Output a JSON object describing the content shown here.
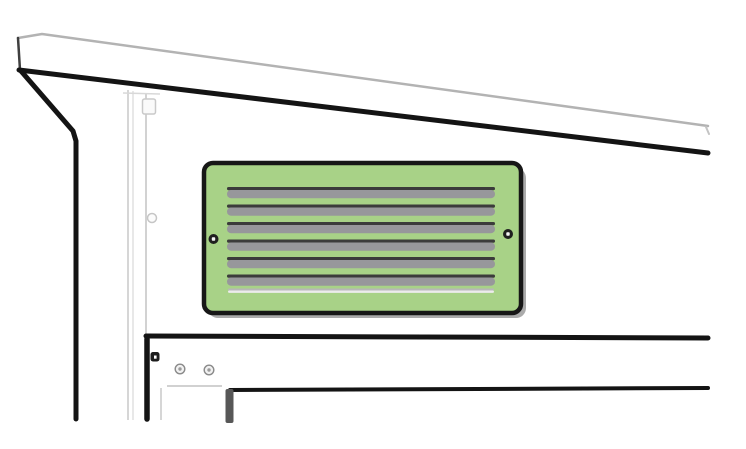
{
  "canvas": {
    "width": 746,
    "height": 449,
    "background": "#ffffff"
  },
  "colors": {
    "outline_dark": "#141414",
    "outline_medium": "#3f3f3f",
    "fascia_gray": "#b3b3b3",
    "post_light_gray": "#d6d6d6",
    "vent_green": "#a8d287",
    "louver_gray": "#97979b",
    "louver_dark": "#3b3b3b",
    "panel_shadow_gray": "#ababab",
    "screw_dark": "#1f1f1f",
    "jamb_gray": "#575757"
  },
  "vent_panel": {
    "louver_count": 7,
    "full_louver_count": 6,
    "thin_louver_count": 1,
    "screw_count": 2,
    "fill_color": "#a8d287",
    "x": 204,
    "y": 163,
    "width": 317,
    "height": 150,
    "corner_radius": 9
  },
  "frame": {
    "rail_screw_count": 2,
    "rail_bolt_count": 1
  },
  "shapes": [
    {
      "name": "fascia-top-edge-line",
      "tag": "polyline",
      "attrs": {
        "points": "18,38 42,34 708,126",
        "fill": "none",
        "stroke": "#b3b3b3",
        "stroke-width": "2.5",
        "stroke-linecap": "round",
        "stroke-linejoin": "round"
      }
    },
    {
      "name": "fascia-left-edge-line",
      "tag": "polyline",
      "attrs": {
        "points": "18,38 20,70",
        "fill": "none",
        "stroke": "#3f3f3f",
        "stroke-width": "2.5",
        "stroke-linecap": "round"
      }
    },
    {
      "name": "fascia-right-end-tick",
      "tag": "polyline",
      "attrs": {
        "points": "706,127 709,134",
        "fill": "none",
        "stroke": "#c4c4c4",
        "stroke-width": "2",
        "stroke-linecap": "round"
      }
    },
    {
      "name": "eave-bottom-line",
      "tag": "polyline",
      "attrs": {
        "points": "19,70 708,153",
        "fill": "none",
        "stroke": "#141414",
        "stroke-width": "5",
        "stroke-linecap": "round"
      }
    },
    {
      "name": "corner-trim-line",
      "tag": "polyline",
      "attrs": {
        "points": "21,71 73,131 76,141 76,419",
        "fill": "none",
        "stroke": "#141414",
        "stroke-width": "5",
        "stroke-linecap": "round",
        "stroke-linejoin": "round"
      }
    },
    {
      "name": "post-edge-line-outer",
      "tag": "polyline",
      "attrs": {
        "points": "128,90 128,420",
        "fill": "none",
        "stroke": "#d6d6d6",
        "stroke-width": "2"
      }
    },
    {
      "name": "post-edge-line-inner",
      "tag": "polyline",
      "attrs": {
        "points": "133,91 133,420",
        "fill": "none",
        "stroke": "#e0e0e0",
        "stroke-width": "1.5"
      }
    },
    {
      "name": "post-edge-line-right",
      "tag": "polyline",
      "attrs": {
        "points": "146,93 146,334",
        "fill": "none",
        "stroke": "#d2d2d2",
        "stroke-width": "2"
      }
    },
    {
      "name": "post-cap-line",
      "tag": "polyline",
      "attrs": {
        "points": "123,93 160,94",
        "fill": "none",
        "stroke": "#d8d8d8",
        "stroke-width": "1.5"
      }
    },
    {
      "name": "post-bracket",
      "tag": "rect",
      "attrs": {
        "x": "142.5",
        "y": "99",
        "width": "13",
        "height": "15",
        "rx": "2",
        "fill": "#fafafa",
        "stroke": "#c9c9c9",
        "stroke-width": "1.5"
      }
    },
    {
      "name": "post-screw",
      "tag": "circle",
      "attrs": {
        "cx": "152",
        "cy": "218",
        "r": "4.5",
        "fill": "#fcfcfc",
        "stroke": "#c6c6c6",
        "stroke-width": "1.5"
      }
    },
    {
      "name": "vent-panel-shadow",
      "tag": "rect",
      "attrs": {
        "x": "208",
        "y": "168",
        "width": "318",
        "height": "150",
        "rx": "10",
        "fill": "#ababab"
      }
    },
    {
      "name": "vent-panel-face",
      "tag": "rect",
      "attrs": {
        "x": "204",
        "y": "163",
        "width": "317",
        "height": "150",
        "rx": "9",
        "fill": "#a8d287",
        "stroke": "#171717",
        "stroke-width": "4.5"
      }
    },
    {
      "name": "louver-1-edge",
      "tag": "rect",
      "attrs": {
        "x": "227",
        "y": "187",
        "width": "268",
        "height": "3.2",
        "rx": "1.6",
        "fill": "#3b3b3b"
      }
    },
    {
      "name": "louver-1-body",
      "tag": "rect",
      "attrs": {
        "x": "227",
        "y": "190",
        "width": "268",
        "height": "8.2",
        "rx": "4",
        "fill": "#97979b"
      }
    },
    {
      "name": "louver-2-edge",
      "tag": "rect",
      "attrs": {
        "x": "227",
        "y": "204.5",
        "width": "268",
        "height": "3.2",
        "rx": "1.6",
        "fill": "#3b3b3b"
      }
    },
    {
      "name": "louver-2-body",
      "tag": "rect",
      "attrs": {
        "x": "227",
        "y": "207.5",
        "width": "268",
        "height": "8.2",
        "rx": "4",
        "fill": "#97979b"
      }
    },
    {
      "name": "louver-3-edge",
      "tag": "rect",
      "attrs": {
        "x": "227",
        "y": "222",
        "width": "268",
        "height": "3.2",
        "rx": "1.6",
        "fill": "#3b3b3b"
      }
    },
    {
      "name": "louver-3-body",
      "tag": "rect",
      "attrs": {
        "x": "227",
        "y": "225",
        "width": "268",
        "height": "8.2",
        "rx": "4",
        "fill": "#97979b"
      }
    },
    {
      "name": "louver-4-edge",
      "tag": "rect",
      "attrs": {
        "x": "227",
        "y": "239.5",
        "width": "268",
        "height": "3.2",
        "rx": "1.6",
        "fill": "#3b3b3b"
      }
    },
    {
      "name": "louver-4-body",
      "tag": "rect",
      "attrs": {
        "x": "227",
        "y": "242.5",
        "width": "268",
        "height": "8.2",
        "rx": "4",
        "fill": "#97979b"
      }
    },
    {
      "name": "louver-5-edge",
      "tag": "rect",
      "attrs": {
        "x": "227",
        "y": "257",
        "width": "268",
        "height": "3.2",
        "rx": "1.6",
        "fill": "#3b3b3b"
      }
    },
    {
      "name": "louver-5-body",
      "tag": "rect",
      "attrs": {
        "x": "227",
        "y": "260",
        "width": "268",
        "height": "8.2",
        "rx": "4",
        "fill": "#97979b"
      }
    },
    {
      "name": "louver-6-edge",
      "tag": "rect",
      "attrs": {
        "x": "227",
        "y": "274.5",
        "width": "268",
        "height": "3.2",
        "rx": "1.6",
        "fill": "#3b3b3b"
      }
    },
    {
      "name": "louver-6-body",
      "tag": "rect",
      "attrs": {
        "x": "227",
        "y": "277.5",
        "width": "268",
        "height": "8.2",
        "rx": "4",
        "fill": "#97979b"
      }
    },
    {
      "name": "louver-7-thin-edge",
      "tag": "rect",
      "attrs": {
        "x": "228",
        "y": "288.5",
        "width": "266",
        "height": "2",
        "rx": "1",
        "fill": "#b7b7b7"
      }
    },
    {
      "name": "louver-7-thin-body",
      "tag": "rect",
      "attrs": {
        "x": "228",
        "y": "290.5",
        "width": "266",
        "height": "2.4",
        "rx": "1.2",
        "fill": "#ececec"
      }
    },
    {
      "name": "panel-screw-left",
      "tag": "circle",
      "attrs": {
        "cx": "213.5",
        "cy": "239",
        "r": "5",
        "fill": "#1f1f1f"
      }
    },
    {
      "name": "panel-screw-left-center",
      "tag": "rect",
      "attrs": {
        "x": "211.8",
        "y": "237.3",
        "width": "3.4",
        "height": "3.4",
        "rx": "0.8",
        "fill": "#f5f5f5"
      }
    },
    {
      "name": "panel-screw-right",
      "tag": "circle",
      "attrs": {
        "cx": "508",
        "cy": "234",
        "r": "5",
        "fill": "#1f1f1f"
      }
    },
    {
      "name": "panel-screw-right-center",
      "tag": "rect",
      "attrs": {
        "x": "506.3",
        "y": "232.3",
        "width": "3.4",
        "height": "3.4",
        "rx": "0.8",
        "fill": "#f5f5f5"
      }
    },
    {
      "name": "rail-top-line",
      "tag": "polyline",
      "attrs": {
        "points": "146,336 708,338",
        "fill": "none",
        "stroke": "#141414",
        "stroke-width": "5",
        "stroke-linecap": "round"
      }
    },
    {
      "name": "rail-left-edge-line",
      "tag": "polyline",
      "attrs": {
        "points": "147,339 147,419",
        "fill": "none",
        "stroke": "#141414",
        "stroke-width": "5.5",
        "stroke-linecap": "round"
      }
    },
    {
      "name": "rail-bolt",
      "tag": "rect",
      "attrs": {
        "x": "150.5",
        "y": "352",
        "width": "9",
        "height": "9.5",
        "rx": "2.5",
        "fill": "#1c1c1c"
      }
    },
    {
      "name": "rail-bolt-center",
      "tag": "rect",
      "attrs": {
        "x": "154",
        "y": "355.5",
        "width": "2.6",
        "height": "3.2",
        "fill": "#ffffff"
      }
    },
    {
      "name": "rail-screw-1",
      "tag": "circle",
      "attrs": {
        "cx": "180",
        "cy": "369",
        "r": "4.8",
        "fill": "#f1f1f1",
        "stroke": "#8a8a8a",
        "stroke-width": "1.4"
      }
    },
    {
      "name": "rail-screw-1-center",
      "tag": "circle",
      "attrs": {
        "cx": "180",
        "cy": "369",
        "r": "1.7",
        "fill": "#9b9b9b"
      }
    },
    {
      "name": "rail-screw-2",
      "tag": "circle",
      "attrs": {
        "cx": "209",
        "cy": "370",
        "r": "4.8",
        "fill": "#f1f1f1",
        "stroke": "#8a8a8a",
        "stroke-width": "1.4"
      }
    },
    {
      "name": "rail-screw-2-center",
      "tag": "circle",
      "attrs": {
        "cx": "209",
        "cy": "370",
        "r": "1.7",
        "fill": "#9b9b9b"
      }
    },
    {
      "name": "rail-bottom-line",
      "tag": "polyline",
      "attrs": {
        "points": "167,386 222,386",
        "fill": "none",
        "stroke": "#c2c2c2",
        "stroke-width": "1.6"
      }
    },
    {
      "name": "post-lower-edge-line",
      "tag": "polyline",
      "attrs": {
        "points": "161,388 161,420",
        "fill": "none",
        "stroke": "#d6d6d6",
        "stroke-width": "2"
      }
    },
    {
      "name": "doorframe-top-line",
      "tag": "polyline",
      "attrs": {
        "points": "230,390 708,388",
        "fill": "none",
        "stroke": "#141414",
        "stroke-width": "4",
        "stroke-linecap": "round"
      }
    },
    {
      "name": "doorframe-jamb",
      "tag": "rect",
      "attrs": {
        "x": "225.5",
        "y": "389",
        "width": "8",
        "height": "34",
        "rx": "2",
        "fill": "#575757"
      }
    }
  ]
}
